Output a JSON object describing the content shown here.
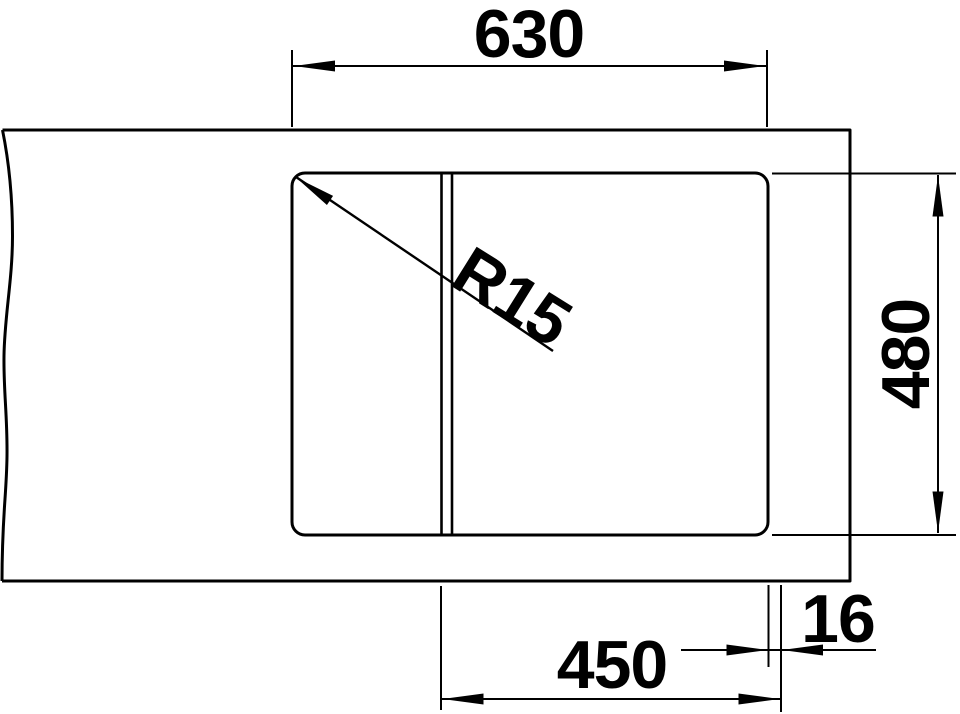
{
  "drawing": {
    "labels": {
      "top_width": "630",
      "side_height": "480",
      "bottom_width": "450",
      "edge_offset": "16",
      "corner_radius": "R15"
    },
    "colors": {
      "line": "#000000",
      "background": "#ffffff"
    }
  }
}
